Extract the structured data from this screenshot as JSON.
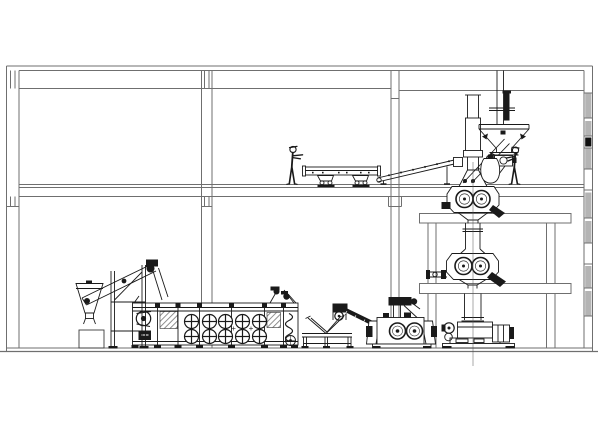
{
  "meta": {
    "title": "Industrial feed-mill plant — sectional elevation CAD line drawing",
    "canvas": {
      "width": 600,
      "height": 421
    },
    "floors": 2,
    "text_in_image": "none — pure line drawing, no labels or dimensions visible"
  },
  "colors": {
    "background": "#ffffff",
    "structure": "#6f6f6f",
    "machinery": "#1a1a1a",
    "hatchfill": "#b4b4b4",
    "solid": "#111111"
  },
  "building": {
    "elements": [
      {
        "id": "roof",
        "label": "flat roof with double edge line"
      },
      {
        "id": "left-wall",
        "label": "left exterior wall / column"
      },
      {
        "id": "middle-column",
        "label": "interior column with capitals"
      },
      {
        "id": "beam-column",
        "label": "interior column with roof beam pocket"
      },
      {
        "id": "right-wall",
        "label": "right exterior wall, section-hatched segments"
      },
      {
        "id": "upper-floor-slab",
        "label": "second floor slab"
      },
      {
        "id": "ground-line",
        "label": "ground / foundation line"
      },
      {
        "id": "mezzanine-platforms",
        "label": "two steel platforms of the milling tower"
      }
    ]
  },
  "equipment": {
    "ground_floor": [
      {
        "id": "feeder-elevator",
        "label": "feed hopper with inclined bucket elevator"
      },
      {
        "id": "floor-box",
        "label": "small crate / box on floor"
      },
      {
        "id": "belt-dryer",
        "label": "belt dryer with circulation fans",
        "fan_rows": 2,
        "fan_columns": 5,
        "fan_total": 10
      },
      {
        "id": "screener-stand",
        "label": "V-trough screening station with drive motor"
      },
      {
        "id": "transfer-chute",
        "label": "inclined transfer chute"
      },
      {
        "id": "roller-crumbler",
        "label": "double-roll crumbler with top drive"
      },
      {
        "id": "pellet-mill",
        "label": "pellet mill with side motor at tower base"
      }
    ],
    "tower": [
      {
        "id": "roller-mill-upper",
        "label": "upper two-roll mill"
      },
      {
        "id": "roller-mill-lower",
        "label": "lower two-roll mill"
      },
      {
        "id": "connecting-ducts",
        "label": "vertical connecting ducts"
      },
      {
        "id": "process-pipe",
        "label": "vertical process pipe with collar"
      },
      {
        "id": "support-strut",
        "label": "diagonal support strut"
      }
    ],
    "upper_floor": [
      {
        "id": "vibrating-conveyor",
        "label": "vibrating trough conveyor on two mounts"
      },
      {
        "id": "inclined-belt-conveyor",
        "label": "inclined belt conveyor"
      },
      {
        "id": "weigh-hopper",
        "label": "weighing hopper with roof feed pipe"
      },
      {
        "id": "rotary-valve",
        "label": "rotary discharge valve"
      },
      {
        "id": "discharge-bag",
        "label": "bagging sack under valve"
      }
    ]
  },
  "figures": [
    {
      "id": "worker-left",
      "label": "operator standing on upper floor, arm extended right"
    },
    {
      "id": "worker-right",
      "label": "operator at bagging station, arm extended left"
    }
  ]
}
